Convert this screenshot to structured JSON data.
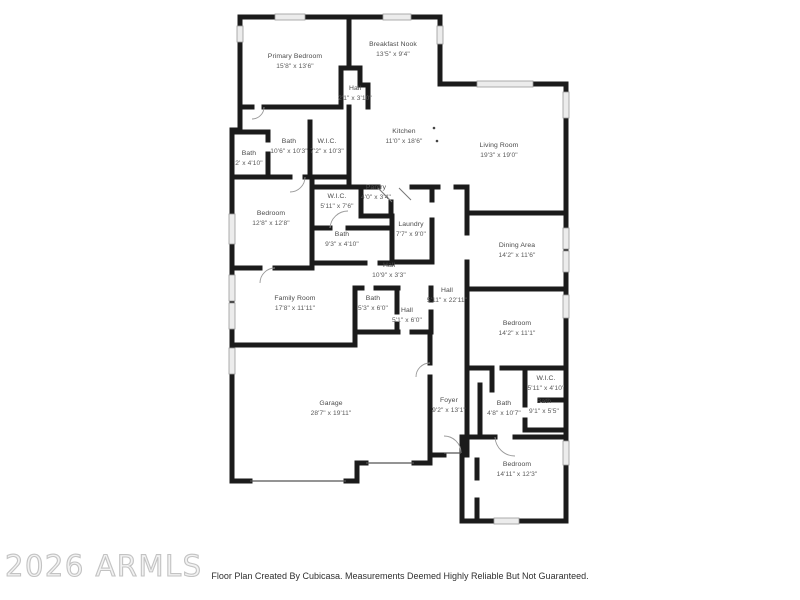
{
  "watermark": "2026 ARMLS",
  "footer": "Floor Plan Created By Cubicasa. Measurements Deemed Highly Reliable But Not Guaranteed.",
  "colors": {
    "wall": "#1b1b1b",
    "window_fill": "#ececec",
    "window_stroke": "#9a9a9a",
    "label_text": "#4a4a4a",
    "footer_text": "#2f2f2f",
    "watermark_stroke": "#c3c3c3",
    "background": "#ffffff"
  },
  "rooms": [
    {
      "name": "Primary Bedroom",
      "dims": "15'8\" x 13'6\"",
      "x": 295,
      "y": 62
    },
    {
      "name": "Breakfast Nook",
      "dims": "13'5\" x 9'4\"",
      "x": 393,
      "y": 50
    },
    {
      "name": "Hall",
      "dims": "2'1\" x 3'10\"",
      "x": 355,
      "y": 94
    },
    {
      "name": "Bath",
      "dims": "10'6\" x 10'3\"",
      "x": 289,
      "y": 147
    },
    {
      "name": "Bath",
      "dims": "2' x 4'10\"",
      "x": 249,
      "y": 159
    },
    {
      "name": "W.I.C.",
      "dims": "7'2\" x 10'3\"",
      "x": 327,
      "y": 147
    },
    {
      "name": "Kitchen",
      "dims": "11'0\" x 18'6\"",
      "x": 404,
      "y": 137
    },
    {
      "name": "Living Room",
      "dims": "19'3\" x 19'0\"",
      "x": 499,
      "y": 151
    },
    {
      "name": "Pantry",
      "dims": "4'0\" x 3'4\"",
      "x": 376,
      "y": 193
    },
    {
      "name": "W.I.C.",
      "dims": "5'11\" x 7'6\"",
      "x": 337,
      "y": 202
    },
    {
      "name": "Bedroom",
      "dims": "12'8\" x 12'8\"",
      "x": 271,
      "y": 219
    },
    {
      "name": "Laundry",
      "dims": "7'7\" x 9'0\"",
      "x": 411,
      "y": 230
    },
    {
      "name": "Bath",
      "dims": "9'3\" x 4'10\"",
      "x": 342,
      "y": 240
    },
    {
      "name": "Dining Area",
      "dims": "14'2\" x 11'6\"",
      "x": 517,
      "y": 251
    },
    {
      "name": "Hall",
      "dims": "10'9\" x 3'3\"",
      "x": 389,
      "y": 271
    },
    {
      "name": "Family Room",
      "dims": "17'8\" x 11'11\"",
      "x": 295,
      "y": 304
    },
    {
      "name": "Bath",
      "dims": "5'3\" x 6'0\"",
      "x": 373,
      "y": 304
    },
    {
      "name": "Hall",
      "dims": "5'1\" x 6'0\"",
      "x": 407,
      "y": 316
    },
    {
      "name": "Hall",
      "dims": "5'11\" x 22'11\"",
      "x": 447,
      "y": 296
    },
    {
      "name": "Bedroom",
      "dims": "14'2\" x 11'1\"",
      "x": 517,
      "y": 329
    },
    {
      "name": "W.I.C.",
      "dims": "5'11\" x 4'10\"",
      "x": 546,
      "y": 384
    },
    {
      "name": "Bath",
      "dims": "4'8\" x 10'7\"",
      "x": 504,
      "y": 409
    },
    {
      "name": "Bath",
      "dims": "9'1\" x 5'5\"",
      "x": 544,
      "y": 407
    },
    {
      "name": "Garage",
      "dims": "28'7\" x 19'11\"",
      "x": 331,
      "y": 409
    },
    {
      "name": "Foyer",
      "dims": "9'2\" x 13'1\"",
      "x": 449,
      "y": 406
    },
    {
      "name": "Bedroom",
      "dims": "14'11\" x 12'3\"",
      "x": 517,
      "y": 470
    }
  ]
}
